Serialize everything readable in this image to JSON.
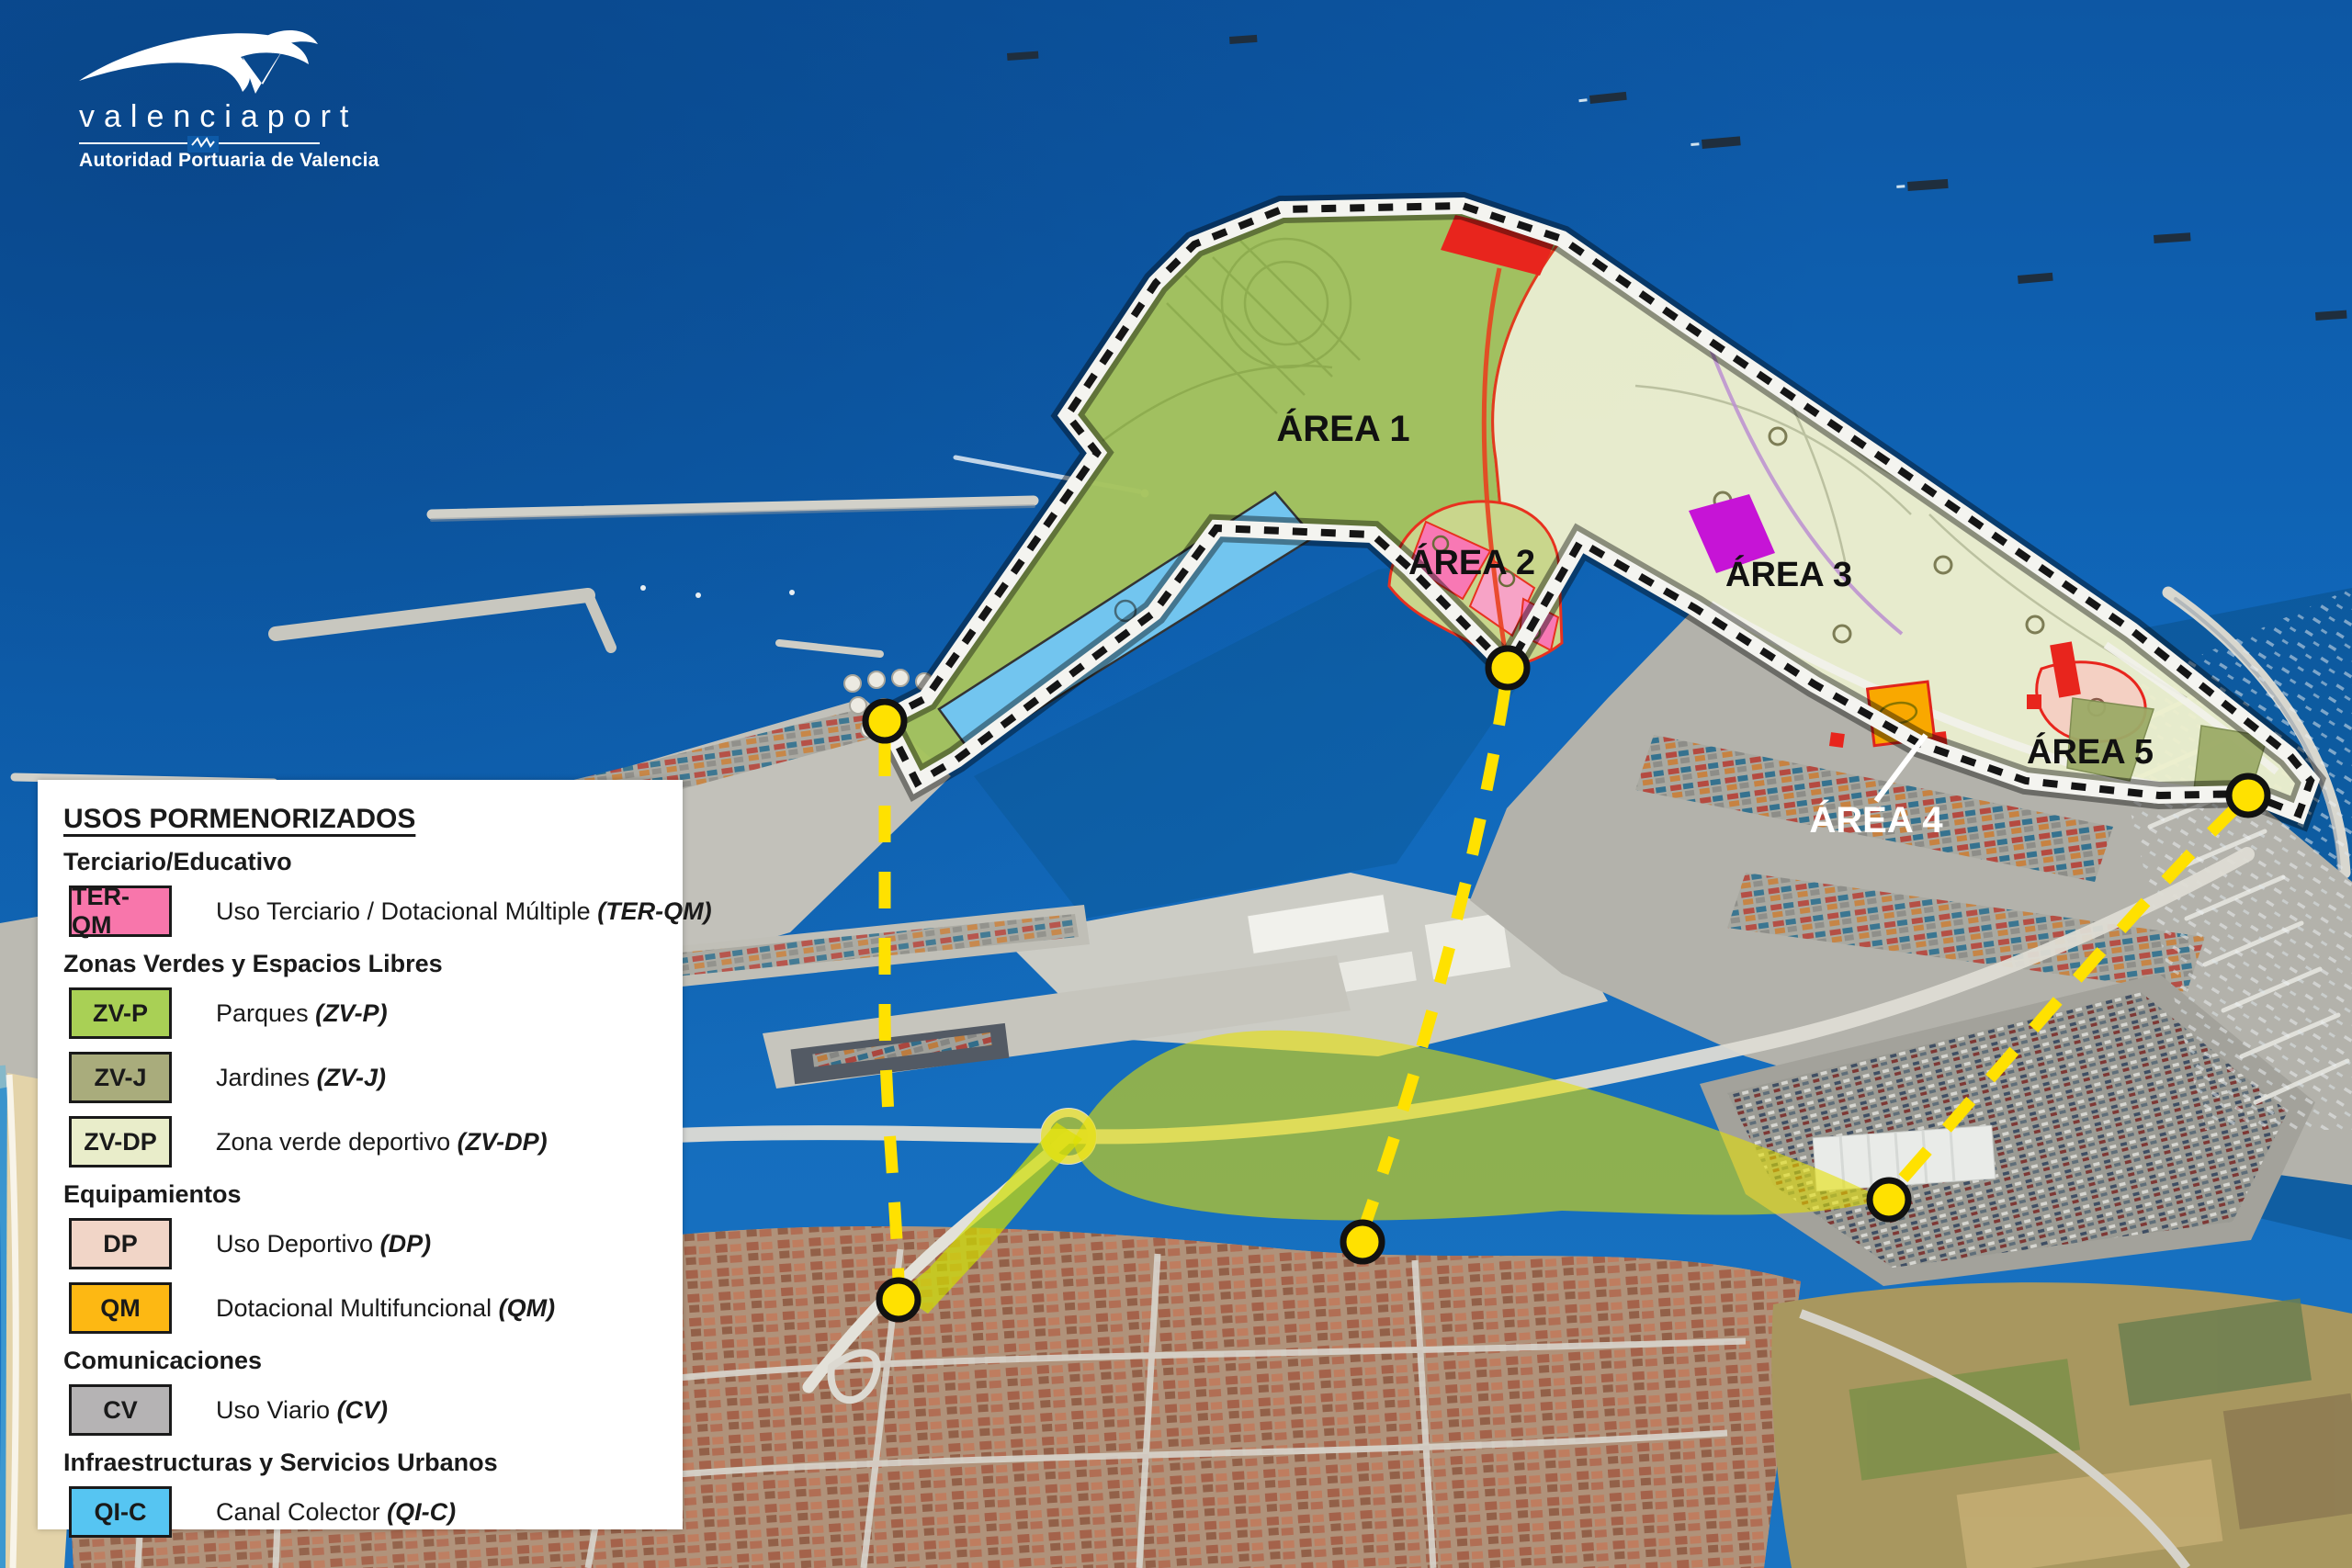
{
  "logo": {
    "brand": "valenciaport",
    "subtitle": "Autoridad Portuaria de Valencia"
  },
  "legend": {
    "title": "USOS PORMENORIZADOS",
    "sections": [
      {
        "heading": "Terciario/Educativo",
        "items": [
          {
            "code": "TER-QM",
            "label": "Uso Terciario / Dotacional Múltiple ",
            "label_code": "(TER-QM)",
            "color": "#f876ab"
          }
        ]
      },
      {
        "heading": "Zonas Verdes y Espacios Libres",
        "items": [
          {
            "code": "ZV-P",
            "label": "Parques ",
            "label_code": "(ZV-P)",
            "color": "#a9d055"
          },
          {
            "code": "ZV-J",
            "label": "Jardines ",
            "label_code": "(ZV-J)",
            "color": "#a9ac7c"
          },
          {
            "code": "ZV-DP",
            "label": "Zona verde deportivo ",
            "label_code": "(ZV-DP)",
            "color": "#e9edca"
          }
        ]
      },
      {
        "heading": "Equipamientos",
        "items": [
          {
            "code": "DP",
            "label": "Uso Deportivo ",
            "label_code": "(DP)",
            "color": "#f1d5c7"
          },
          {
            "code": "QM",
            "label": "Dotacional Multifuncional ",
            "label_code": "(QM)",
            "color": "#fdb813"
          }
        ]
      },
      {
        "heading": "Comunicaciones",
        "items": [
          {
            "code": "CV",
            "label": "Uso Viario ",
            "label_code": "(CV)",
            "color": "#b5b3b4"
          }
        ]
      },
      {
        "heading": "Infraestructuras y Servicios Urbanos",
        "items": [
          {
            "code": "QI-C",
            "label": "Canal Colector ",
            "label_code": "(QI-C)",
            "color": "#56c5f2"
          }
        ]
      }
    ]
  },
  "map": {
    "area_labels": [
      {
        "text": "ÁREA 1",
        "color": "#111111"
      },
      {
        "text": "ÁREA 2",
        "color": "#111111"
      },
      {
        "text": "ÁREA 3",
        "color": "#111111"
      },
      {
        "text": "ÁREA 4",
        "color": "#ffffff"
      },
      {
        "text": "ÁREA 5",
        "color": "#111111"
      }
    ],
    "overlay_colors": {
      "parks_green": "#a6c45e",
      "sports_pale_green": "#eef0ce",
      "canal_blue": "#72c5ef",
      "ter_qm_pink": "#f878b4",
      "qm_orange": "#f9a800",
      "dp_pale_pink": "#f4d0c3",
      "zvj_olive": "#9cab67",
      "magenta_zone": "#c614d6",
      "red_zone": "#e8251d",
      "highlight_yellow": "#e6e000",
      "route_yellow": "#ffe100"
    }
  }
}
